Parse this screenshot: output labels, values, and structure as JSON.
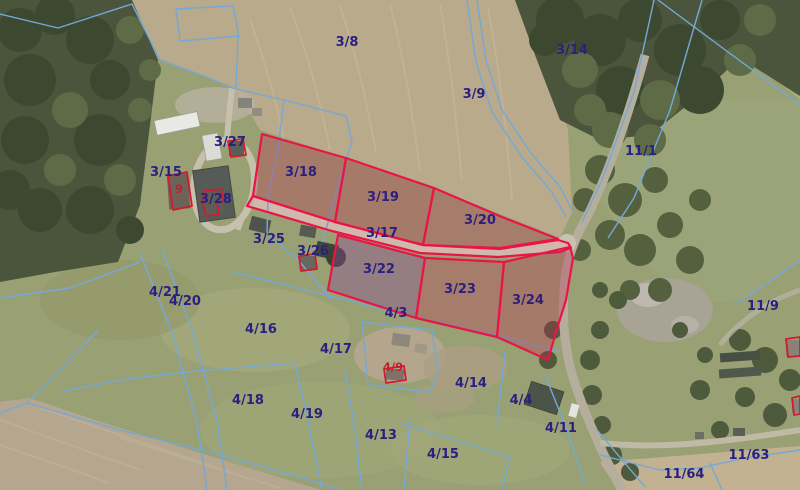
{
  "map": {
    "title": "Aerial cadastral map with highlighted land parcels",
    "type": "orthophoto-with-cadastre",
    "colors": {
      "parcel_label": "#2b2080",
      "building_label": "#c21f2f",
      "cadastral_line_blue": "#74a8d8",
      "highlight_outline_red": "#ea1446",
      "highlight_fill_red": "rgba(196,36,84,0.30)",
      "highlight_fill_purple": "rgba(141,74,152,0.40)",
      "building_outline_red": "#d01c30"
    },
    "highlighted_parcel_ids": [
      "3/17",
      "3/18",
      "3/19",
      "3/20",
      "3/22",
      "3/23",
      "3/24"
    ],
    "labels": {
      "parcels": [
        {
          "id": "3/8",
          "text": "3/8",
          "x": 347,
          "y": 46
        },
        {
          "id": "3/14",
          "text": "3/14",
          "x": 572,
          "y": 54
        },
        {
          "id": "3/9",
          "text": "3/9",
          "x": 474,
          "y": 98
        },
        {
          "id": "11/1",
          "text": "11/1",
          "x": 641,
          "y": 155
        },
        {
          "id": "3/27",
          "text": "3/27",
          "x": 230,
          "y": 146
        },
        {
          "id": "3/15",
          "text": "3/15",
          "x": 166,
          "y": 176
        },
        {
          "id": "3/28",
          "text": "3/28",
          "x": 216,
          "y": 203
        },
        {
          "id": "3/18",
          "text": "3/18",
          "x": 301,
          "y": 176
        },
        {
          "id": "3/19",
          "text": "3/19",
          "x": 383,
          "y": 201
        },
        {
          "id": "3/20",
          "text": "3/20",
          "x": 480,
          "y": 224
        },
        {
          "id": "3/17",
          "text": "3/17",
          "x": 382,
          "y": 237
        },
        {
          "id": "3/25",
          "text": "3/25",
          "x": 269,
          "y": 243
        },
        {
          "id": "3/26",
          "text": "3/26",
          "x": 313,
          "y": 255
        },
        {
          "id": "3/22",
          "text": "3/22",
          "x": 379,
          "y": 273
        },
        {
          "id": "3/23",
          "text": "3/23",
          "x": 460,
          "y": 293
        },
        {
          "id": "3/24",
          "text": "3/24",
          "x": 528,
          "y": 304
        },
        {
          "id": "4/3",
          "text": "4/3",
          "x": 396,
          "y": 317
        },
        {
          "id": "4/21",
          "text": "4/21",
          "x": 165,
          "y": 296
        },
        {
          "id": "4/20",
          "text": "4/20",
          "x": 185,
          "y": 305
        },
        {
          "id": "4/16",
          "text": "4/16",
          "x": 261,
          "y": 333
        },
        {
          "id": "4/17",
          "text": "4/17",
          "x": 336,
          "y": 353
        },
        {
          "id": "4/18",
          "text": "4/18",
          "x": 248,
          "y": 404
        },
        {
          "id": "4/19",
          "text": "4/19",
          "x": 307,
          "y": 418
        },
        {
          "id": "4/13",
          "text": "4/13",
          "x": 381,
          "y": 439
        },
        {
          "id": "4/14",
          "text": "4/14",
          "x": 471,
          "y": 387
        },
        {
          "id": "4/4",
          "text": "4/4",
          "x": 521,
          "y": 404
        },
        {
          "id": "4/11",
          "text": "4/11",
          "x": 561,
          "y": 432
        },
        {
          "id": "4/15",
          "text": "4/15",
          "x": 443,
          "y": 458
        },
        {
          "id": "11/9",
          "text": "11/9",
          "x": 763,
          "y": 310
        },
        {
          "id": "11/63",
          "text": "11/63",
          "x": 749,
          "y": 459
        },
        {
          "id": "11/64",
          "text": "11/64",
          "x": 684,
          "y": 478
        }
      ],
      "buildings": [
        {
          "id": "9",
          "text": "9",
          "x": 179,
          "y": 193
        },
        {
          "id": "4/9",
          "text": "4/9",
          "x": 393,
          "y": 371
        }
      ]
    }
  }
}
